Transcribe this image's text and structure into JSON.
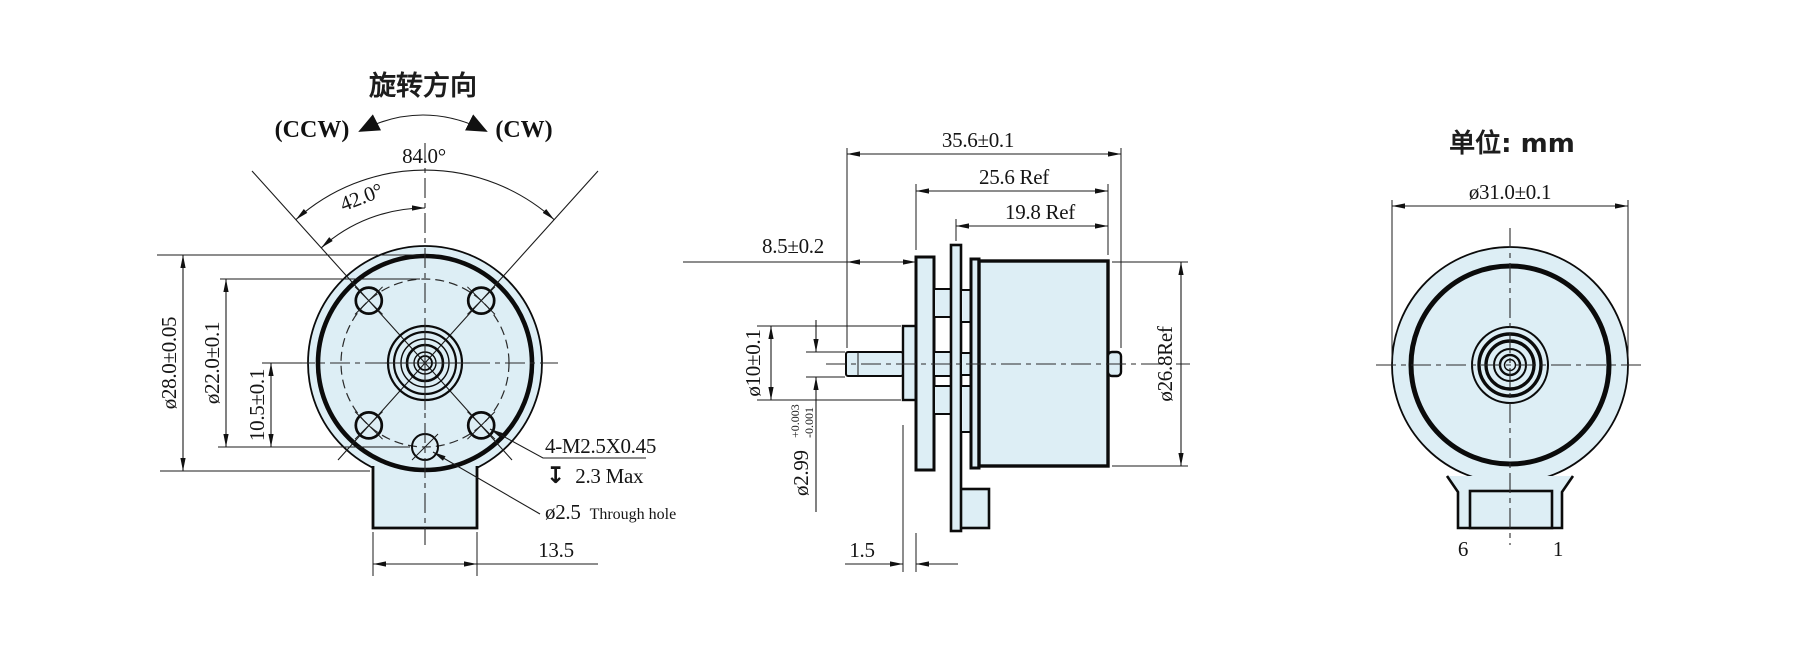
{
  "colors": {
    "part_fill": "#ddeef5",
    "line": "#1b1b1b"
  },
  "front_view": {
    "rotation_title": "旋转方向",
    "ccw": "(CCW)",
    "cw": "(CW)",
    "angle_full": "84.0°",
    "angle_half": "42.0°",
    "dia_body": "ø28.0±0.05",
    "dia_bolt_circle": "ø22.0±0.1",
    "hole_offset": "10.5±0.1",
    "screw_spec": "4-M2.5X0.45",
    "depth_symbol": "↧",
    "depth_note": "2.3 Max",
    "through_hole_dia": "ø2.5",
    "through_hole_note": "Through hole",
    "tab_width": "13.5"
  },
  "side_view": {
    "total_length": "35.6±0.1",
    "body_length": "25.6 Ref",
    "rear_length": "19.8 Ref",
    "shaft_extension": "8.5±0.2",
    "boss_dia": "ø10±0.1",
    "shaft_dia": "ø2.99",
    "shaft_tol_upper": "+0.003",
    "shaft_tol_lower": "-0.001",
    "flange_gap": "1.5",
    "body_dia": "ø26.8Ref"
  },
  "rear_view": {
    "unit_note": "单位: mm",
    "dia_flange": "ø31.0±0.1",
    "pin_left_label": "6",
    "pin_right_label": "1"
  }
}
